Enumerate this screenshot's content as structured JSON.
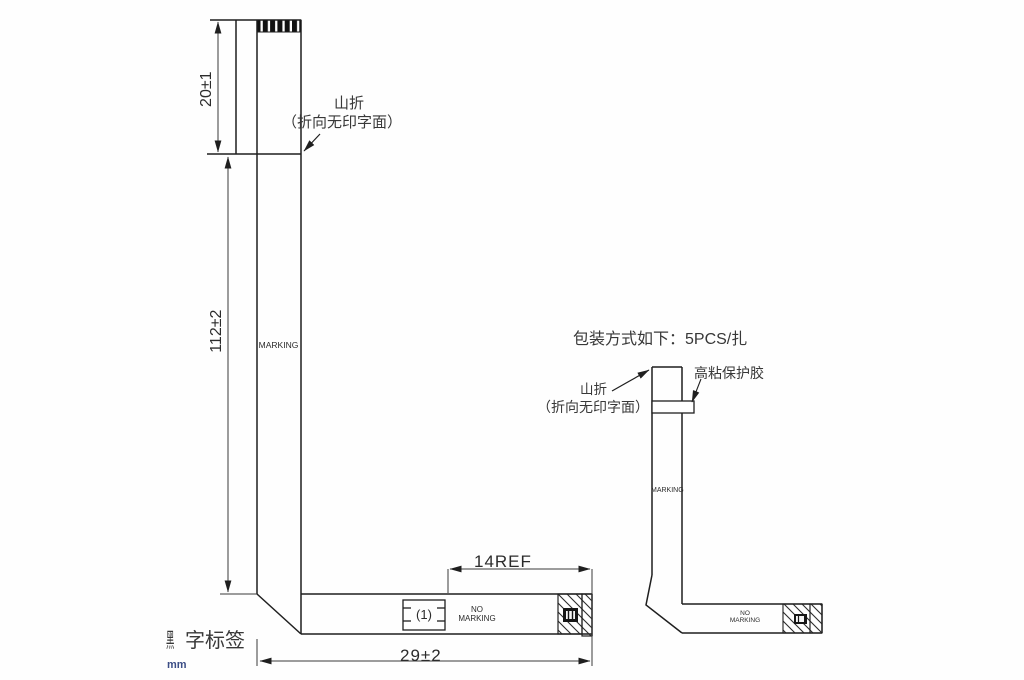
{
  "colors": {
    "line": "#1f1f1f",
    "dim_line": "#3a3a3a",
    "text": "#2b2b2b",
    "unit_text": "#3c4e86",
    "contact_fill": "#111111"
  },
  "unit_label": "mm",
  "left_view": {
    "dim_top": "20±1",
    "dim_side": "112±2",
    "dim_bottom": "29±2",
    "dim_ref": "14REF",
    "fold_note_line1": "山折",
    "fold_note_line2": "（折向无印字面）",
    "marking_text": "MARKING",
    "no_marking_text": "NO\nMARKING",
    "circled_ref": "(1)",
    "label_prefix": "黑",
    "label_rest": "字标签"
  },
  "right_view": {
    "packaging_note": "包装方式如下：5PCS/扎",
    "fold_note_line1": "山折",
    "fold_note_line2": "（折向无印字面）",
    "tape_note": "高粘保护胶",
    "marking_text": "MARKING",
    "no_marking_text": "NO\nMARKING"
  }
}
